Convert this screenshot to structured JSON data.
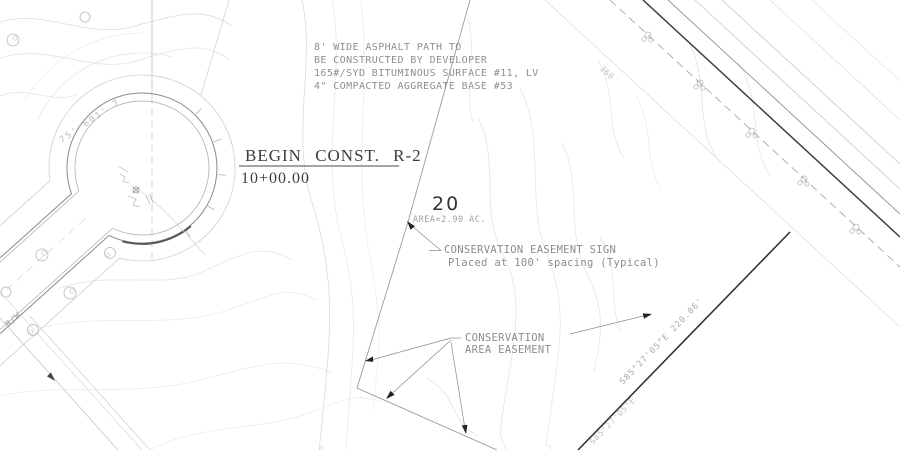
{
  "drawing": {
    "asphalt_note": {
      "line1": "8' WIDE ASPHALT PATH TO",
      "line2": "BE CONSTRUCTED BY DEVELOPER",
      "line3": "165#/SYD BITUMINOUS SURFACE #11, LV",
      "line4": "4\" COMPACTED AGGREGATE BASE #53"
    },
    "begin_const": {
      "title": "BEGIN CONST. R-2",
      "station": "10+00.00"
    },
    "lot20": {
      "number": "20",
      "area": "AREA=2.90 AC."
    },
    "easement_sign_note": {
      "line1": "CONSERVATION EASEMENT SIGN",
      "line2": "Placed at 100' spacing (Typical)"
    },
    "area_easement_note": {
      "line1": "CONSERVATION",
      "line2": "AREA EASEMENT"
    },
    "bearing_label": "S85°27'05\"E  220.06'",
    "bearing_label_secondary": "S85°27'05\"E",
    "rw_label": "R/W",
    "curve_label": "75' 601' 7",
    "contour_label": "360"
  },
  "colors": {
    "background": "#ffffff",
    "boundary_dark": "#333333",
    "boundary_light": "#9a9a9a",
    "road_edge": "#8a8a8a",
    "contour": "#dcdcdc",
    "text_dark": "#3d3d3d",
    "text_gray": "#8a8a8a",
    "arrow_fill": "#222222"
  }
}
